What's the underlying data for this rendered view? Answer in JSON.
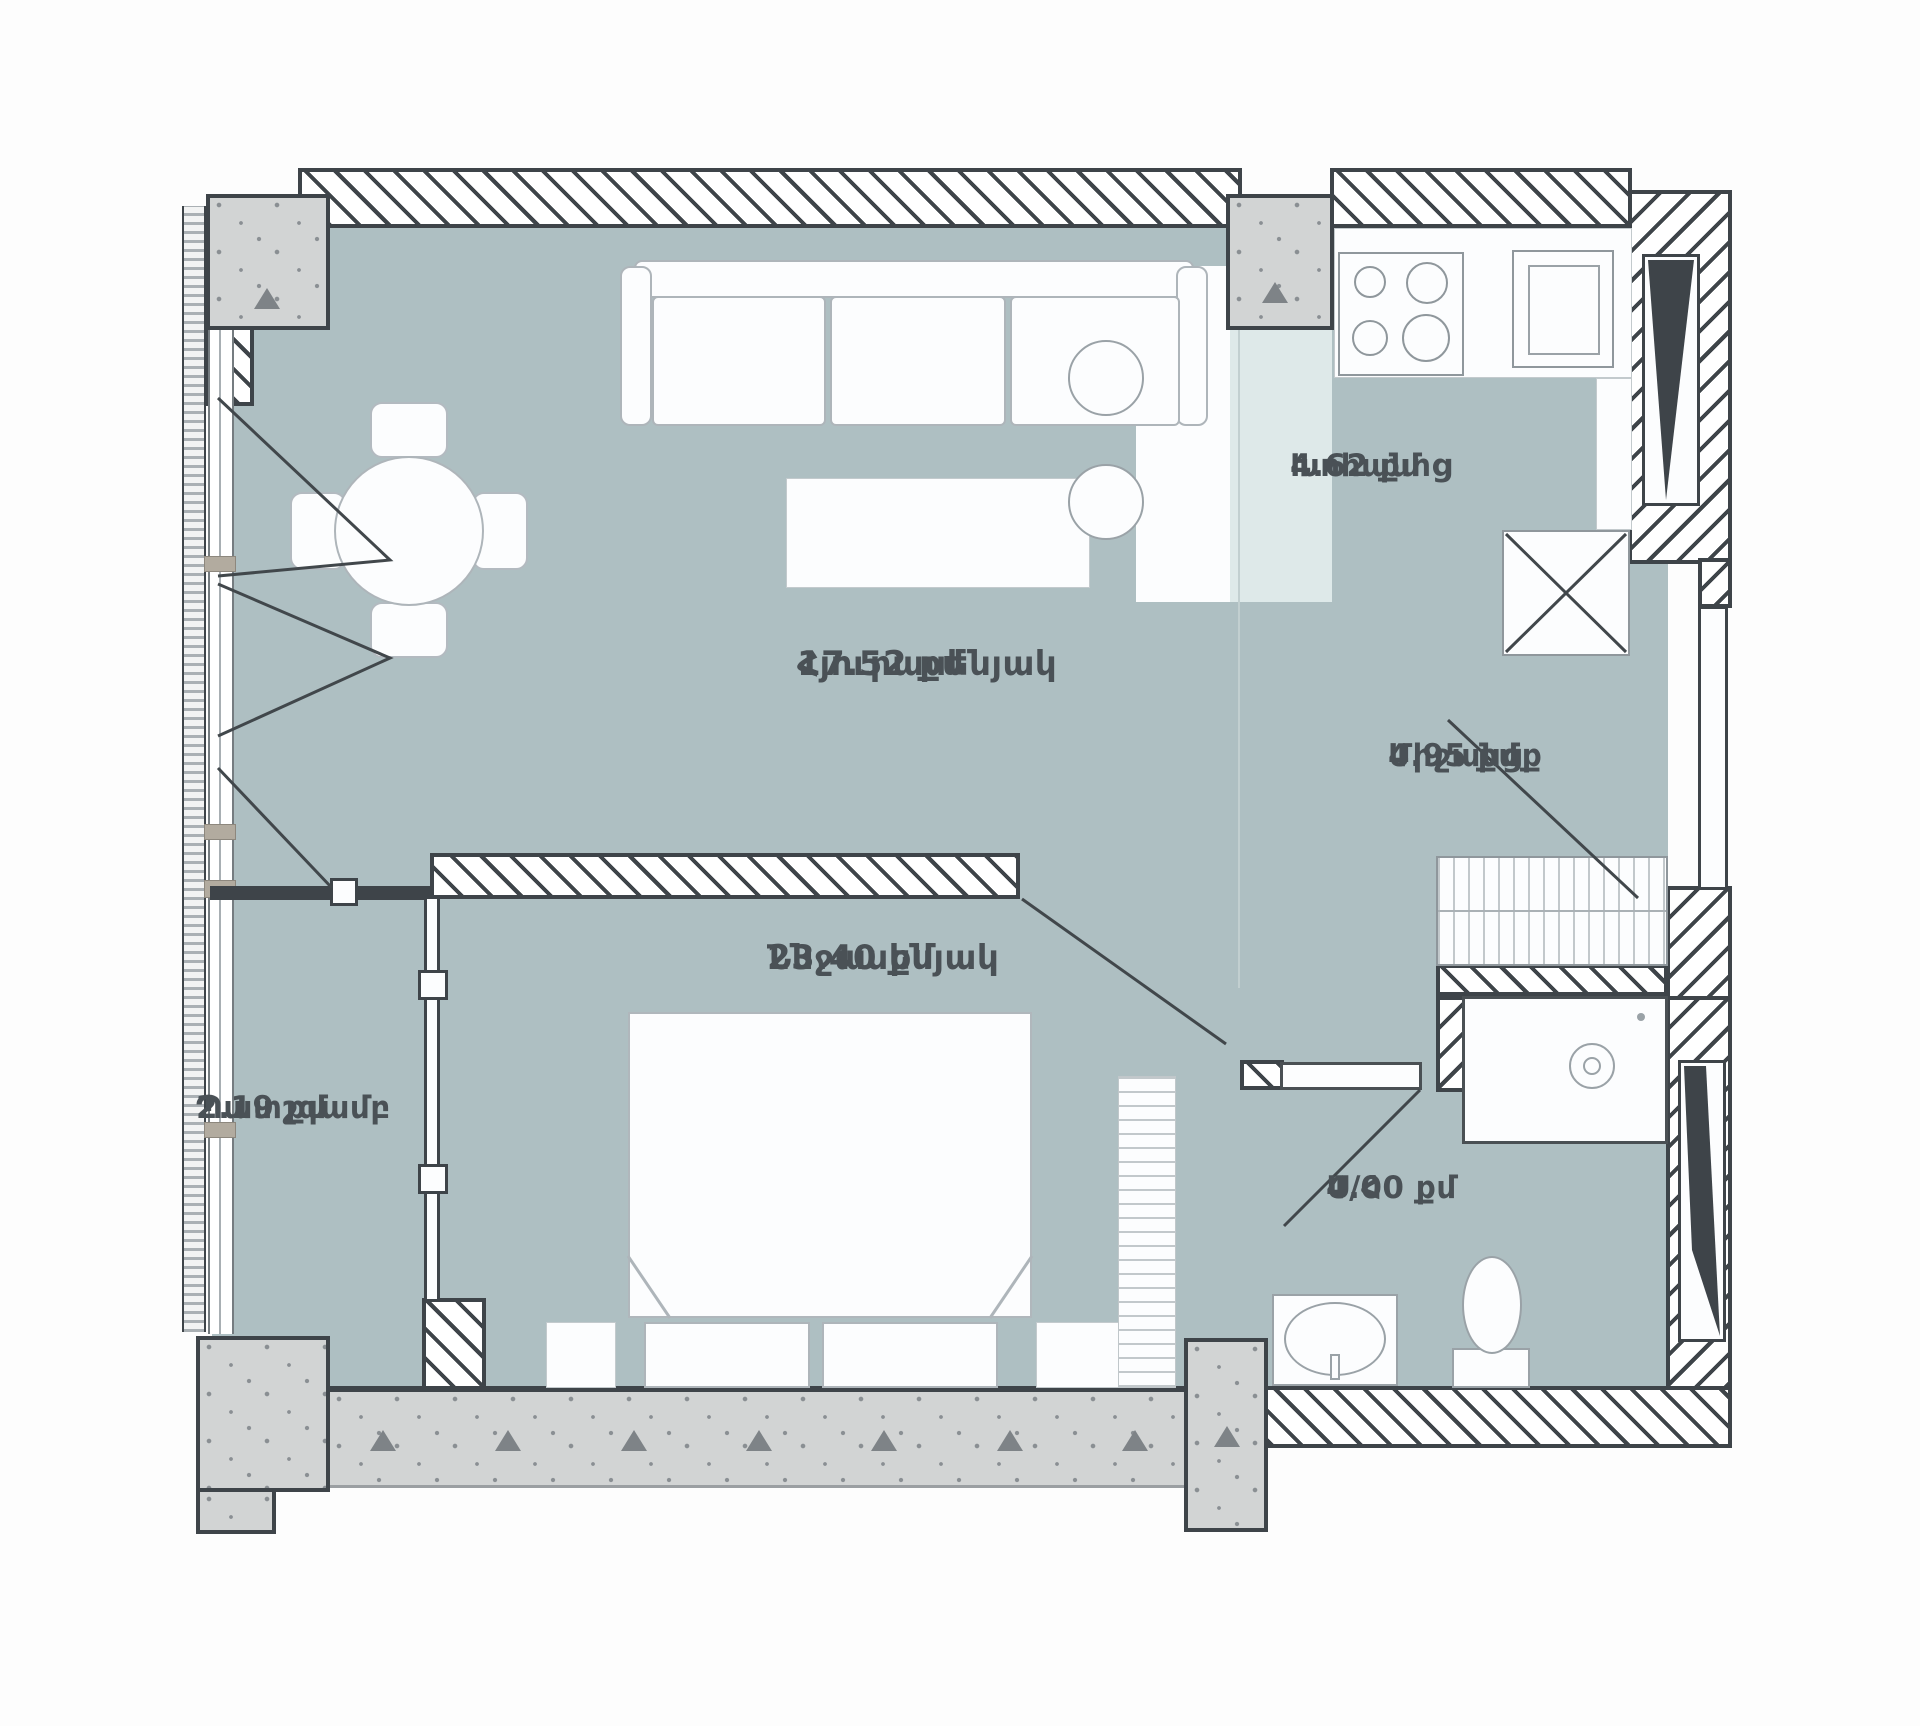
{
  "plan": {
    "colors": {
      "floor": "#aebfc2",
      "floor_light": "#dee9e9",
      "wall": "#3e4449",
      "concrete": "#d2d4d4",
      "text": "#4a5156",
      "furniture_line": "#9aa2a7"
    },
    "rooms": [
      {
        "name": "Հյուրասենյակ",
        "area": "17.52 քմ"
      },
      {
        "name": "Խոհանոց",
        "area": "4.62 քմ"
      },
      {
        "name": "Միջանցք",
        "area": "4.95 քմ"
      },
      {
        "name": "Ննջասենյակ",
        "area": "23.40 քմ"
      },
      {
        "name": "Պատշգամբ",
        "area": "2.19 քմ"
      },
      {
        "name": "Ս/Հ",
        "area": "4.00 քմ"
      }
    ]
  }
}
